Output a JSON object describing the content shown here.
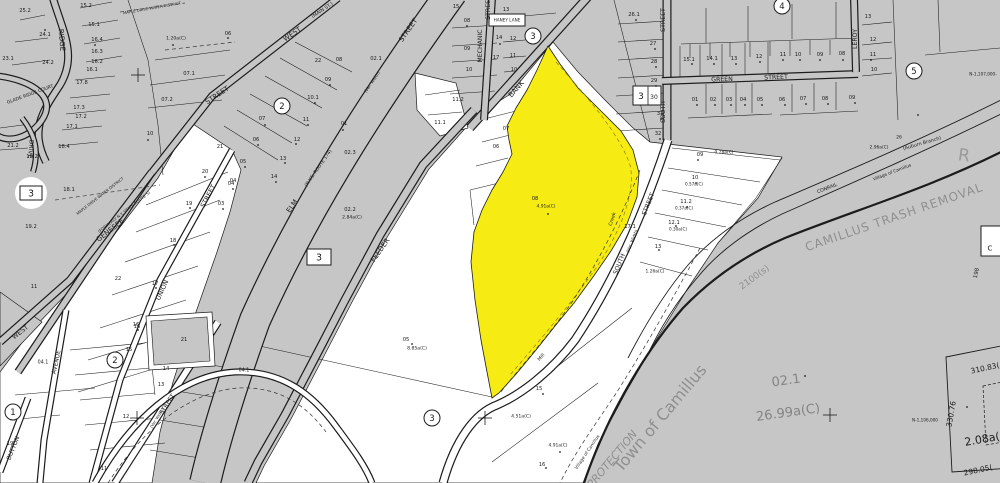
{
  "map_type": "tax-parcel-plat-map",
  "colors": {
    "base": "#c6c6c6",
    "parcel_white": "#ffffff",
    "highlight_yellow": "#f6ec13",
    "ink": "#1c1c1c",
    "muted": "#8f8f8f",
    "boundary_dash": "#8f8000"
  },
  "highlighted_parcel": {
    "number": "08",
    "area": "4.91a(C)",
    "color": "#f6ec13"
  },
  "labels": [
    {
      "t": "RIDGE",
      "x": 62,
      "y": 40,
      "s": 7,
      "r": 85,
      "n": "street-label-ridge"
    },
    {
      "t": "GLADE RIDGE COURT",
      "x": 30,
      "y": 94,
      "s": 4.6,
      "r": -20,
      "n": "street-label-glade-ridge-court"
    },
    {
      "t": "DRIVE",
      "x": 31,
      "y": 149,
      "s": 6,
      "r": 95,
      "n": "street-label-drive"
    },
    {
      "t": "MAPLE DRIVE WATER DISTRICT",
      "x": 152,
      "y": 8,
      "s": 3.8,
      "r": -10,
      "n": "district-label"
    },
    {
      "t": "MAPLE DRIVE WATER DISTRICT",
      "x": 100,
      "y": 196,
      "s": 3.8,
      "r": -38,
      "n": "district-label"
    },
    {
      "t": "(MAIN ST.)",
      "x": 322,
      "y": 10,
      "s": 4.8,
      "r": -34,
      "n": "street-label-main-st"
    },
    {
      "t": "WEST",
      "x": 292,
      "y": 34,
      "s": 7,
      "r": -34,
      "n": "street-label-west"
    },
    {
      "t": "STREET",
      "x": 217,
      "y": 95,
      "s": 7,
      "r": -34,
      "n": "street-label-west-street"
    },
    {
      "t": "WEST",
      "x": 20,
      "y": 332,
      "s": 6.5,
      "r": -38,
      "n": "street-label-west"
    },
    {
      "t": "STREET",
      "x": 408,
      "y": 30,
      "s": 7,
      "r": -55,
      "n": "street-label-elm-street"
    },
    {
      "t": "(Var. Width)",
      "x": 372,
      "y": 82,
      "s": 4.2,
      "r": -55,
      "n": "street-label-var-width"
    },
    {
      "t": "(N.Y.S. ROUTE 174)",
      "x": 318,
      "y": 168,
      "s": 4.6,
      "r": -55,
      "n": "street-label-route-174"
    },
    {
      "t": "ELM",
      "x": 292,
      "y": 206,
      "s": 7,
      "r": -55,
      "n": "street-label-elm"
    },
    {
      "t": "GENESEE",
      "x": 110,
      "y": 230,
      "s": 7,
      "r": -38,
      "n": "street-label-genesee"
    },
    {
      "t": "(FORMERLY N.Y. STATE ROUTE 5)",
      "x": 124,
      "y": 212,
      "s": 4,
      "r": -38,
      "n": "street-label-route-5"
    },
    {
      "t": "UNION",
      "x": 162,
      "y": 290,
      "s": 6.5,
      "r": -65,
      "n": "street-label-union"
    },
    {
      "t": "STREET",
      "x": 208,
      "y": 196,
      "s": 6.5,
      "r": -62,
      "n": "street-label-union-street"
    },
    {
      "t": "FEEDER",
      "x": 380,
      "y": 250,
      "s": 7,
      "r": -55,
      "n": "street-label-feeder"
    },
    {
      "t": "BANK",
      "x": 516,
      "y": 89,
      "s": 7,
      "r": -49,
      "n": "street-label-bank"
    },
    {
      "t": "MECHANIC",
      "x": 480,
      "y": 46,
      "s": 6.2,
      "r": -90,
      "n": "street-label-mechanic"
    },
    {
      "t": "STREET",
      "x": 488,
      "y": 8,
      "s": 6.2,
      "r": -90,
      "n": "street-label-mechanic-street"
    },
    {
      "t": "HANEY LANE",
      "x": 507,
      "y": 20,
      "s": 4.2,
      "n": "street-label-haney-lane"
    },
    {
      "t": "STREET",
      "x": 663,
      "y": 20,
      "s": 6.2,
      "r": -90,
      "n": "street-label-south-street"
    },
    {
      "t": "SOUTH",
      "x": 663,
      "y": 112,
      "s": 6.2,
      "r": -90,
      "n": "street-label-south"
    },
    {
      "t": "GREEN",
      "x": 722,
      "y": 79,
      "s": 6.2,
      "r": -2,
      "n": "street-label-green"
    },
    {
      "t": "STREET",
      "x": 776,
      "y": 77,
      "s": 6.2,
      "r": -2,
      "n": "street-label-green-street"
    },
    {
      "t": "LEROY",
      "x": 855,
      "y": 39,
      "s": 6.2,
      "r": -90,
      "n": "street-label-leroy"
    },
    {
      "t": "STREET",
      "x": 648,
      "y": 204,
      "s": 6.2,
      "r": -68,
      "n": "street-label-south-street-lower"
    },
    {
      "t": "(Var. Width)",
      "x": 632,
      "y": 241,
      "s": 4.2,
      "r": -68,
      "n": "street-label-var-width"
    },
    {
      "t": "SOUTH",
      "x": 619,
      "y": 264,
      "s": 6.2,
      "r": -68,
      "n": "street-label-south-lower"
    },
    {
      "t": "Mill",
      "x": 541,
      "y": 357,
      "s": 4.8,
      "r": -50,
      "n": "street-label-mill"
    },
    {
      "t": "Creek",
      "x": 612,
      "y": 219,
      "s": 4.8,
      "r": -72,
      "n": "water-label-creek"
    },
    {
      "t": "CONRAIL",
      "x": 827,
      "y": 188,
      "s": 4.8,
      "r": -21,
      "n": "railroad-label-conrail"
    },
    {
      "t": "Village of Camillus",
      "x": 892,
      "y": 172,
      "s": 4.4,
      "r": -21,
      "n": "boundary-label-village"
    },
    {
      "t": "(Auburn Branch)",
      "x": 922,
      "y": 143,
      "s": 4.8,
      "r": -16,
      "n": "railroad-label-auburn-branch"
    },
    {
      "t": "Village of Camillus",
      "x": 587,
      "y": 452,
      "s": 4.4,
      "r": -56,
      "n": "boundary-label-village"
    },
    {
      "t": "BUTTON",
      "x": 13,
      "y": 448,
      "s": 6,
      "r": -68,
      "n": "street-label-button"
    },
    {
      "t": "AVENUE",
      "x": 56,
      "y": 362,
      "s": 6,
      "r": -78,
      "n": "street-label-avenue"
    },
    {
      "t": "STREET",
      "x": 167,
      "y": 404,
      "s": 6,
      "r": -57,
      "n": "street-label-street-diag"
    },
    {
      "t": "(Var. Width)",
      "x": 157,
      "y": 418,
      "s": 3.8,
      "r": -57,
      "n": "street-label-var-width"
    },
    {
      "t": "CAMILLUS TRASH REMOVAL",
      "x": 894,
      "y": 217,
      "s": 12,
      "r": -19,
      "c": "#8f8f8f",
      "ls": 1,
      "n": "area-label-camillus-trash-removal"
    },
    {
      "t": "Town of Camillus",
      "x": 660,
      "y": 418,
      "s": 16,
      "r": -50,
      "c": "#8f8f8f",
      "n": "boundary-label-town-of-camillus"
    },
    {
      "t": "PROTECTION",
      "x": 612,
      "y": 459,
      "s": 11,
      "r": -50,
      "c": "#8f8f8f",
      "i": true,
      "n": "boundary-label-protection"
    },
    {
      "t": "02.1",
      "x": 786,
      "y": 380,
      "s": 13,
      "r": -8,
      "c": "#848484",
      "n": "parcel-number-large"
    },
    {
      "t": "26.99a(C)",
      "x": 788,
      "y": 412,
      "s": 13,
      "r": -8,
      "c": "#848484",
      "n": "parcel-area-large"
    },
    {
      "t": "R",
      "x": 964,
      "y": 155,
      "s": 17,
      "r": 8,
      "c": "#9a9a9a",
      "n": "partial-letter-r"
    },
    {
      "t": "2100(s)",
      "x": 754,
      "y": 277,
      "s": 9,
      "r": -36,
      "c": "#8f8f8f",
      "n": "map-ref-label"
    },
    {
      "t": "198",
      "x": 976,
      "y": 273,
      "s": 5.5,
      "r": -78
    },
    {
      "t": "2.08a(C)",
      "x": 988,
      "y": 438,
      "s": 11,
      "r": -10,
      "n": "parcel-area-label"
    },
    {
      "t": "310.83(",
      "x": 985,
      "y": 368,
      "s": 7.5,
      "r": -12,
      "n": "dimension-label"
    },
    {
      "t": "330.76",
      "x": 951,
      "y": 414,
      "s": 7.5,
      "r": -80,
      "n": "dimension-label"
    },
    {
      "t": "298.05(",
      "x": 978,
      "y": 470,
      "s": 7.5,
      "r": -12,
      "n": "dimension-label"
    },
    {
      "t": "N-1,106,000",
      "x": 925,
      "y": 420,
      "s": 4.2,
      "n": "grid-coordinate-label"
    },
    {
      "t": "N-1,107,000-",
      "x": 983,
      "y": 74,
      "s": 4.2,
      "n": "grid-coordinate-label"
    },
    {
      "t": "1",
      "x": 13,
      "y": 412,
      "s": 8.5,
      "n": "circled-section-number"
    },
    {
      "t": "2",
      "x": 282,
      "y": 106,
      "s": 8.5,
      "n": "circled-section-number"
    },
    {
      "t": "2",
      "x": 115,
      "y": 360,
      "s": 8.5,
      "n": "circled-section-number"
    },
    {
      "t": "3",
      "x": 533,
      "y": 36,
      "s": 8.5,
      "n": "circled-section-number"
    },
    {
      "t": "3",
      "x": 432,
      "y": 418,
      "s": 8.5,
      "n": "circled-section-number"
    },
    {
      "t": "4",
      "x": 782,
      "y": 6,
      "s": 8.5,
      "n": "circled-section-number"
    },
    {
      "t": "5",
      "x": 914,
      "y": 71,
      "s": 8.5,
      "n": "circled-section-number"
    },
    {
      "t": "3",
      "x": 31,
      "y": 193,
      "s": 9.5,
      "n": "boxed-section-number"
    },
    {
      "t": "3",
      "x": 319,
      "y": 257,
      "s": 9.5,
      "n": "boxed-section-number"
    },
    {
      "t": "3",
      "x": 641,
      "y": 96,
      "s": 9,
      "n": "boxed-section-number"
    },
    {
      "t": "30",
      "x": 654,
      "y": 97,
      "s": 6,
      "n": "parcel-number"
    },
    {
      "t": "C",
      "x": 990,
      "y": 248,
      "s": 7,
      "n": "partial-letter"
    },
    {
      "t": "25.2",
      "x": 25,
      "y": 10
    },
    {
      "t": "24.1",
      "x": 45,
      "y": 34
    },
    {
      "t": "24.2",
      "x": 48,
      "y": 62
    },
    {
      "t": "23.1",
      "x": 8,
      "y": 58
    },
    {
      "t": "15.2",
      "x": 86,
      "y": 5
    },
    {
      "t": "15.1",
      "x": 94,
      "y": 24
    },
    {
      "t": "16.4",
      "x": 97,
      "y": 39
    },
    {
      "t": "16.3",
      "x": 97,
      "y": 51
    },
    {
      "t": "16.2",
      "x": 97,
      "y": 61
    },
    {
      "t": "16.1",
      "x": 92,
      "y": 69
    },
    {
      "t": "17.8",
      "x": 82,
      "y": 82
    },
    {
      "t": "17.3",
      "x": 79,
      "y": 107
    },
    {
      "t": "17.2",
      "x": 81,
      "y": 116
    },
    {
      "t": "17.1",
      "x": 72,
      "y": 126
    },
    {
      "t": "18.4",
      "x": 64,
      "y": 146
    },
    {
      "t": "21.2",
      "x": 13,
      "y": 145
    },
    {
      "t": "19.2",
      "x": 32,
      "y": 156
    },
    {
      "t": "1.20a(C)",
      "x": 176,
      "y": 38,
      "s": 4.6
    },
    {
      "t": "07.1",
      "x": 189,
      "y": 73
    },
    {
      "t": "07.2",
      "x": 167,
      "y": 99
    },
    {
      "t": "06",
      "x": 228,
      "y": 33
    },
    {
      "t": "10",
      "x": 150,
      "y": 133
    },
    {
      "t": "21",
      "x": 220,
      "y": 146
    },
    {
      "t": "18.1",
      "x": 69,
      "y": 189
    },
    {
      "t": "19.2",
      "x": 31,
      "y": 226
    },
    {
      "t": "11",
      "x": 34,
      "y": 286
    },
    {
      "t": "22",
      "x": 118,
      "y": 278
    },
    {
      "t": "20",
      "x": 205,
      "y": 171
    },
    {
      "t": "19",
      "x": 189,
      "y": 203
    },
    {
      "t": "18",
      "x": 173,
      "y": 240
    },
    {
      "t": "17",
      "x": 155,
      "y": 283
    },
    {
      "t": "16",
      "x": 136,
      "y": 324
    },
    {
      "t": "04",
      "x": 233,
      "y": 180
    },
    {
      "t": "02.1",
      "x": 376,
      "y": 58
    },
    {
      "t": "08",
      "x": 339,
      "y": 59
    },
    {
      "t": "22",
      "x": 318,
      "y": 60
    },
    {
      "t": "09",
      "x": 328,
      "y": 79
    },
    {
      "t": "10.1",
      "x": 313,
      "y": 97
    },
    {
      "t": "11",
      "x": 306,
      "y": 119
    },
    {
      "t": "12",
      "x": 297,
      "y": 139
    },
    {
      "t": "01",
      "x": 344,
      "y": 123
    },
    {
      "t": "13",
      "x": 283,
      "y": 158
    },
    {
      "t": "14",
      "x": 274,
      "y": 176
    },
    {
      "t": "07",
      "x": 262,
      "y": 118
    },
    {
      "t": "06",
      "x": 256,
      "y": 139
    },
    {
      "t": "05",
      "x": 243,
      "y": 161
    },
    {
      "t": "04",
      "x": 231,
      "y": 183
    },
    {
      "t": "03",
      "x": 221,
      "y": 203
    },
    {
      "t": "02.3",
      "x": 350,
      "y": 152
    },
    {
      "t": "02.2",
      "x": 350,
      "y": 209
    },
    {
      "t": "2.84a(C)",
      "x": 352,
      "y": 217,
      "s": 4.6
    },
    {
      "t": "15",
      "x": 456,
      "y": 6
    },
    {
      "t": "13",
      "x": 506,
      "y": 9
    },
    {
      "t": "08",
      "x": 467,
      "y": 20
    },
    {
      "t": "09",
      "x": 467,
      "y": 48
    },
    {
      "t": "10",
      "x": 469,
      "y": 69
    },
    {
      "t": "14",
      "x": 499,
      "y": 37
    },
    {
      "t": "12",
      "x": 513,
      "y": 38
    },
    {
      "t": "11",
      "x": 513,
      "y": 55
    },
    {
      "t": "10",
      "x": 514,
      "y": 69
    },
    {
      "t": "17",
      "x": 496,
      "y": 57
    },
    {
      "t": "11.2",
      "x": 458,
      "y": 99
    },
    {
      "t": "11.1",
      "x": 440,
      "y": 122
    },
    {
      "t": "07",
      "x": 506,
      "y": 128
    },
    {
      "t": "06",
      "x": 496,
      "y": 146
    },
    {
      "t": "08",
      "x": 535,
      "y": 198,
      "n": "highlighted-parcel-number"
    },
    {
      "t": "4.91a(C)",
      "x": 546,
      "y": 206,
      "s": 4.4,
      "n": "highlighted-parcel-area"
    },
    {
      "t": "26.1",
      "x": 634,
      "y": 14
    },
    {
      "t": "27",
      "x": 653,
      "y": 43
    },
    {
      "t": "28",
      "x": 654,
      "y": 61
    },
    {
      "t": "29",
      "x": 654,
      "y": 80
    },
    {
      "t": "31",
      "x": 660,
      "y": 113
    },
    {
      "t": "32",
      "x": 658,
      "y": 133
    },
    {
      "t": "15.1",
      "x": 689,
      "y": 59
    },
    {
      "t": "14.1",
      "x": 712,
      "y": 58
    },
    {
      "t": "13",
      "x": 734,
      "y": 58
    },
    {
      "t": "12",
      "x": 759,
      "y": 56
    },
    {
      "t": "01",
      "x": 695,
      "y": 99
    },
    {
      "t": "02",
      "x": 713,
      "y": 99
    },
    {
      "t": "03",
      "x": 729,
      "y": 99
    },
    {
      "t": "04",
      "x": 743,
      "y": 99
    },
    {
      "t": "05",
      "x": 760,
      "y": 99
    },
    {
      "t": "09",
      "x": 700,
      "y": 154
    },
    {
      "t": "0.28a(C)",
      "x": 724,
      "y": 152,
      "s": 4.4
    },
    {
      "t": "10",
      "x": 695,
      "y": 177
    },
    {
      "t": "0.57a(C)",
      "x": 694,
      "y": 184,
      "s": 4.2
    },
    {
      "t": "11.2",
      "x": 686,
      "y": 201
    },
    {
      "t": "0.37a(C)",
      "x": 684,
      "y": 208,
      "s": 4.2
    },
    {
      "t": "12.1",
      "x": 674,
      "y": 222
    },
    {
      "t": "0.30a(C)",
      "x": 678,
      "y": 229,
      "s": 4.2
    },
    {
      "t": "13",
      "x": 658,
      "y": 246
    },
    {
      "t": "17.1",
      "x": 630,
      "y": 226
    },
    {
      "t": "1.26a(C)",
      "x": 655,
      "y": 271,
      "s": 4.4
    },
    {
      "t": "11",
      "x": 783,
      "y": 54
    },
    {
      "t": "10",
      "x": 798,
      "y": 54
    },
    {
      "t": "09",
      "x": 820,
      "y": 54
    },
    {
      "t": "08",
      "x": 842,
      "y": 53
    },
    {
      "t": "13",
      "x": 868,
      "y": 16
    },
    {
      "t": "12",
      "x": 873,
      "y": 39
    },
    {
      "t": "11",
      "x": 873,
      "y": 54
    },
    {
      "t": "10",
      "x": 874,
      "y": 69
    },
    {
      "t": "06",
      "x": 782,
      "y": 99
    },
    {
      "t": "07",
      "x": 803,
      "y": 98
    },
    {
      "t": "08",
      "x": 825,
      "y": 98
    },
    {
      "t": "09",
      "x": 852,
      "y": 97
    },
    {
      "t": "26",
      "x": 899,
      "y": 137,
      "s": 4.6
    },
    {
      "t": "2.96a(C)",
      "x": 879,
      "y": 147,
      "s": 4.4
    },
    {
      "t": "05",
      "x": 406,
      "y": 339
    },
    {
      "t": "8.85a(C)",
      "x": 417,
      "y": 348,
      "s": 4.6
    },
    {
      "t": "15",
      "x": 539,
      "y": 388
    },
    {
      "t": "4.51a(C)",
      "x": 521,
      "y": 416,
      "s": 4.6
    },
    {
      "t": "16",
      "x": 542,
      "y": 464
    },
    {
      "t": "4.91a(C)",
      "x": 558,
      "y": 445,
      "s": 4.4
    },
    {
      "t": "15",
      "x": 129,
      "y": 349
    },
    {
      "t": "14",
      "x": 166,
      "y": 368
    },
    {
      "t": "13",
      "x": 161,
      "y": 384
    },
    {
      "t": "12",
      "x": 126,
      "y": 416
    },
    {
      "t": "11",
      "x": 104,
      "y": 468
    },
    {
      "t": "16",
      "x": 137,
      "y": 326
    },
    {
      "t": "21",
      "x": 184,
      "y": 339
    },
    {
      "t": "04.1",
      "x": 43,
      "y": 362,
      "s": 4.8
    },
    {
      "t": "04.1",
      "x": 244,
      "y": 370,
      "s": 4.8
    },
    {
      "t": "19",
      "x": 10,
      "y": 443
    }
  ]
}
